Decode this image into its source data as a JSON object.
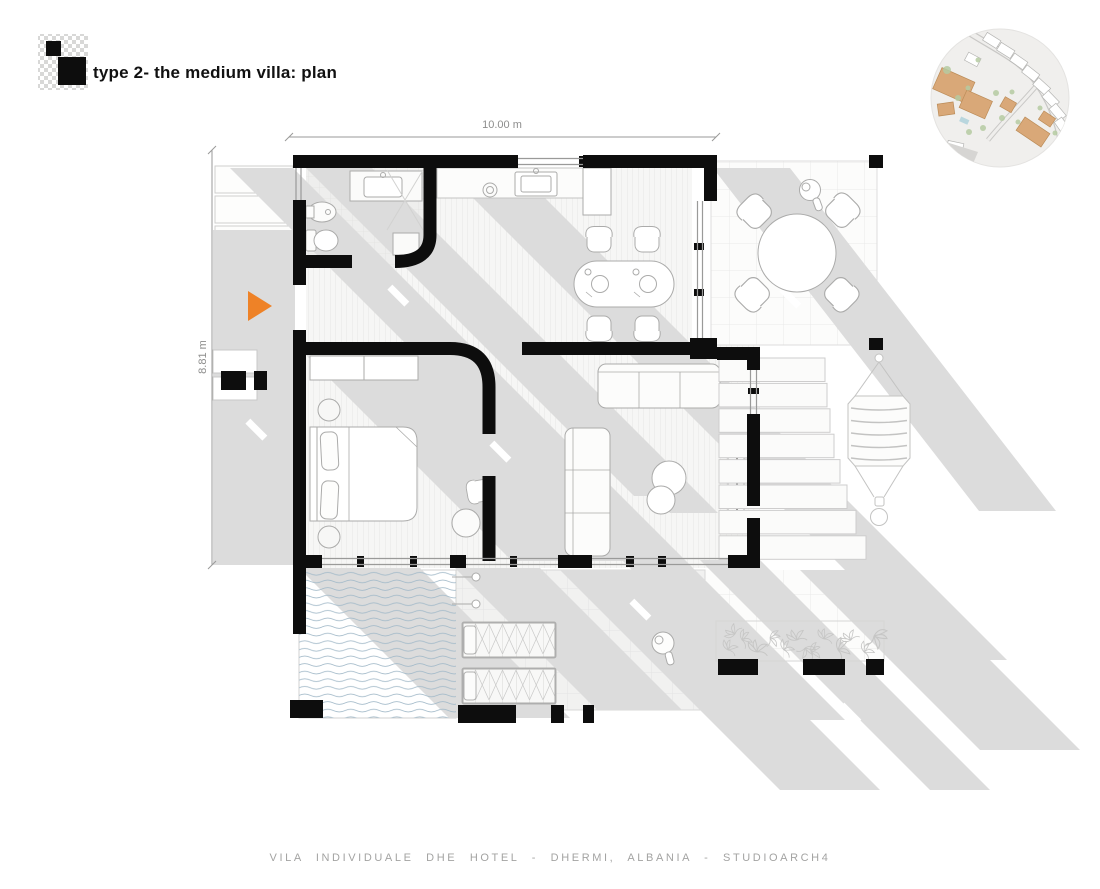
{
  "header": {
    "title": "type 2- the medium villa: plan"
  },
  "dimensions": {
    "width": "10.00 m",
    "height": "8.81 m"
  },
  "footer": {
    "credit": "VILA INDIVIDUALE DHE HOTEL - DHERMI, ALBANIA - STUDIOARCH4"
  },
  "colors": {
    "wall": "#0d0d0d",
    "shadow": "#dcdcdc",
    "accent_orange": "#ee8227",
    "water_line": "#a3bac9",
    "furniture_line": "#ababaa",
    "site_building": "#d9a878",
    "site_green": "#b5cba1"
  }
}
